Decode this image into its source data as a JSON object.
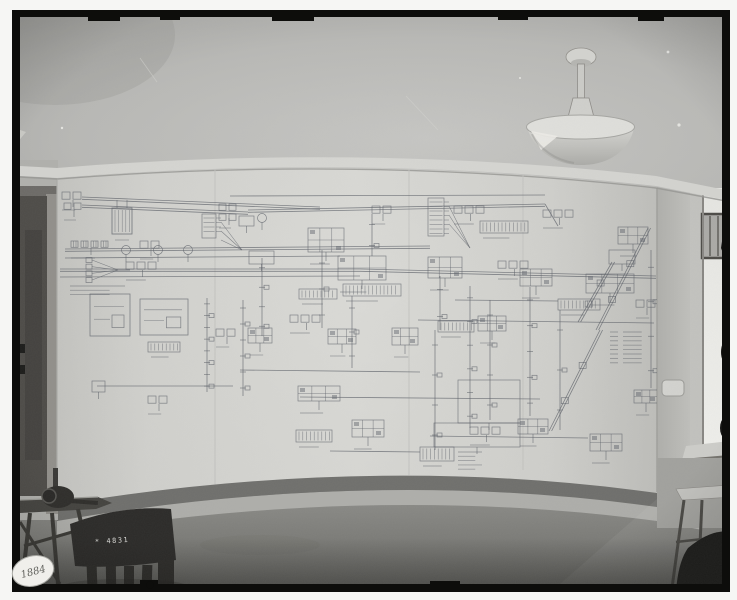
{
  "photo": {
    "kind": "black-and-white room photograph",
    "labels": {
      "chair_number": "* 4831",
      "sticker_number": "1884"
    }
  },
  "palette": {
    "plate_black": "#0d0d0b",
    "ceiling": "#c2c2bf",
    "molding": "#d8d8d4",
    "sheet": "#d8d8d4",
    "ink": "#5c6068",
    "door": "#4f4d49",
    "floor": "#8d8d89",
    "baseboard": "#71716e",
    "window_glass": "#f0f0ec",
    "chair": "#2c2b29",
    "sticker": "#f0efeb",
    "lamp": "#d7d7d3"
  },
  "schematic": {
    "ink": "#5c6068",
    "seams": [
      {
        "x": 215,
        "y1": 168,
        "y2": 498
      },
      {
        "x": 409,
        "y1": 160,
        "y2": 476
      },
      {
        "x": 523,
        "y1": 164,
        "y2": 470
      }
    ],
    "buses": [
      {
        "p": [
          82,
          197,
          320,
          207
        ],
        "d": true
      },
      {
        "p": [
          82,
          205,
          248,
          212
        ],
        "d": true
      },
      {
        "p": [
          248,
          210,
          545,
          204
        ],
        "d": true
      },
      {
        "p": [
          545,
          204,
          558,
          226
        ],
        "d": false
      },
      {
        "p": [
          230,
          196,
          545,
          195
        ],
        "d": false
      },
      {
        "p": [
          65,
          249,
          430,
          246
        ],
        "d": true
      },
      {
        "p": [
          65,
          258,
          340,
          256
        ],
        "d": false
      },
      {
        "p": [
          60,
          269,
          360,
          269
        ],
        "d": true
      },
      {
        "p": [
          360,
          269,
          656,
          276
        ],
        "d": true
      },
      {
        "p": [
          60,
          277,
          360,
          276
        ],
        "d": false
      },
      {
        "p": [
          418,
          320,
          654,
          323
        ],
        "d": false
      },
      {
        "p": [
          455,
          300,
          558,
          301
        ],
        "d": false
      },
      {
        "p": [
          97,
          386,
          233,
          386
        ],
        "d": false
      },
      {
        "p": [
          240,
          370,
          420,
          372
        ],
        "d": false
      },
      {
        "p": [
          300,
          397,
          540,
          399
        ],
        "d": false
      },
      {
        "p": [
          430,
          436,
          588,
          438
        ],
        "d": false
      },
      {
        "p": [
          330,
          451,
          420,
          452
        ],
        "d": false
      }
    ],
    "verticals": [
      {
        "x": 207,
        "y1": 298,
        "y2": 392,
        "t": 8
      },
      {
        "x": 243,
        "y1": 300,
        "y2": 396,
        "t": 6
      },
      {
        "x": 262,
        "y1": 258,
        "y2": 336,
        "t": 4
      },
      {
        "x": 352,
        "y1": 296,
        "y2": 368,
        "t": 3
      },
      {
        "x": 435,
        "y1": 330,
        "y2": 450,
        "t": 4
      },
      {
        "x": 440,
        "y1": 276,
        "y2": 330,
        "t": 2
      },
      {
        "x": 470,
        "y1": 286,
        "y2": 428,
        "t": 6
      },
      {
        "x": 490,
        "y1": 300,
        "y2": 420,
        "t": 4
      },
      {
        "x": 530,
        "y1": 287,
        "y2": 416,
        "t": 5
      },
      {
        "x": 560,
        "y1": 310,
        "y2": 430,
        "t": 3
      },
      {
        "x": 651,
        "y1": 250,
        "y2": 388,
        "t": 4
      },
      {
        "x": 322,
        "y1": 250,
        "y2": 328,
        "t": 3
      },
      {
        "x": 372,
        "y1": 214,
        "y2": 256,
        "t": 2
      }
    ],
    "diagonals": [
      {
        "p": [
          648,
          228,
          596,
          330
        ]
      },
      {
        "p": [
          600,
          330,
          549,
          431
        ]
      },
      {
        "p": [
          612,
          262,
          578,
          322
        ]
      }
    ],
    "clusters": [
      {
        "t": "row",
        "x": 62,
        "y": 192,
        "n": 2,
        "s": 8
      },
      {
        "t": "row",
        "x": 64,
        "y": 203,
        "n": 2,
        "s": 7
      },
      {
        "t": "hatchbox",
        "x": 112,
        "y": 208,
        "w": 20,
        "h": 26
      },
      {
        "t": "vcomb",
        "x": 202,
        "y": 214,
        "w": 14,
        "h": 24
      },
      {
        "t": "grid",
        "x": 219,
        "y": 204,
        "n": 2,
        "s": 7
      },
      {
        "t": "block",
        "x": 239,
        "y": 216,
        "w": 15,
        "h": 10
      },
      {
        "t": "dense",
        "x": 308,
        "y": 228,
        "w": 36,
        "h": 24
      },
      {
        "t": "vcomb",
        "x": 428,
        "y": 198,
        "w": 16,
        "h": 38
      },
      {
        "t": "row",
        "x": 454,
        "y": 206,
        "n": 3,
        "s": 8
      },
      {
        "t": "comb",
        "x": 480,
        "y": 221,
        "w": 48,
        "h": 12
      },
      {
        "t": "row",
        "x": 543,
        "y": 210,
        "n": 3,
        "s": 8
      },
      {
        "t": "dense",
        "x": 618,
        "y": 227,
        "w": 30,
        "h": 17
      },
      {
        "t": "block",
        "x": 609,
        "y": 250,
        "w": 26,
        "h": 14
      },
      {
        "t": "coils",
        "x": 71,
        "y": 241,
        "n": 4,
        "s": 7
      },
      {
        "t": "fan",
        "x": 92,
        "y": 260,
        "w": 26,
        "h": 20
      },
      {
        "t": "row",
        "x": 126,
        "y": 262,
        "n": 3,
        "s": 8
      },
      {
        "t": "circ",
        "x": 126,
        "y": 250
      },
      {
        "t": "circ",
        "x": 158,
        "y": 250
      },
      {
        "t": "circ",
        "x": 188,
        "y": 250
      },
      {
        "t": "row",
        "x": 140,
        "y": 241,
        "n": 2,
        "s": 8
      },
      {
        "t": "block",
        "x": 249,
        "y": 251,
        "w": 25,
        "h": 13
      },
      {
        "t": "dense",
        "x": 338,
        "y": 256,
        "w": 48,
        "h": 24
      },
      {
        "t": "comb",
        "x": 343,
        "y": 284,
        "w": 58,
        "h": 12
      },
      {
        "t": "comb",
        "x": 299,
        "y": 289,
        "w": 38,
        "h": 10
      },
      {
        "t": "dense",
        "x": 428,
        "y": 257,
        "w": 34,
        "h": 21
      },
      {
        "t": "row",
        "x": 498,
        "y": 261,
        "n": 3,
        "s": 8
      },
      {
        "t": "dense",
        "x": 520,
        "y": 269,
        "w": 32,
        "h": 17
      },
      {
        "t": "dense",
        "x": 586,
        "y": 274,
        "w": 48,
        "h": 19
      },
      {
        "t": "comb",
        "x": 558,
        "y": 299,
        "w": 42,
        "h": 11
      },
      {
        "t": "textrows",
        "x": 70,
        "y": 286,
        "n": 3,
        "w": 55
      },
      {
        "t": "blockin",
        "x": 90,
        "y": 294,
        "w": 40,
        "h": 42
      },
      {
        "t": "blockin",
        "x": 140,
        "y": 299,
        "w": 48,
        "h": 36
      },
      {
        "t": "comb",
        "x": 148,
        "y": 342,
        "w": 32,
        "h": 10
      },
      {
        "t": "row",
        "x": 216,
        "y": 329,
        "n": 2,
        "s": 8
      },
      {
        "t": "dense",
        "x": 248,
        "y": 328,
        "w": 24,
        "h": 15
      },
      {
        "t": "row",
        "x": 290,
        "y": 315,
        "n": 3,
        "s": 8
      },
      {
        "t": "dense",
        "x": 328,
        "y": 329,
        "w": 28,
        "h": 15
      },
      {
        "t": "dense",
        "x": 392,
        "y": 328,
        "w": 26,
        "h": 17
      },
      {
        "t": "comb",
        "x": 438,
        "y": 321,
        "w": 36,
        "h": 11
      },
      {
        "t": "dense",
        "x": 478,
        "y": 316,
        "w": 28,
        "h": 15
      },
      {
        "t": "legend",
        "x": 610,
        "y": 332,
        "n": 8,
        "w": 34
      },
      {
        "t": "block",
        "x": 92,
        "y": 381,
        "w": 13,
        "h": 11
      },
      {
        "t": "row",
        "x": 148,
        "y": 396,
        "n": 2,
        "s": 8
      },
      {
        "t": "dense",
        "x": 298,
        "y": 386,
        "w": 42,
        "h": 15
      },
      {
        "t": "comb",
        "x": 296,
        "y": 430,
        "w": 36,
        "h": 12
      },
      {
        "t": "dense",
        "x": 352,
        "y": 420,
        "w": 32,
        "h": 17
      },
      {
        "t": "block",
        "x": 434,
        "y": 423,
        "w": 86,
        "h": 24
      },
      {
        "t": "block",
        "x": 458,
        "y": 380,
        "w": 62,
        "h": 43
      },
      {
        "t": "comb",
        "x": 420,
        "y": 447,
        "w": 34,
        "h": 14
      },
      {
        "t": "textrows",
        "x": 458,
        "y": 452,
        "n": 5,
        "w": 24
      },
      {
        "t": "row",
        "x": 470,
        "y": 427,
        "n": 3,
        "s": 8
      },
      {
        "t": "dense",
        "x": 518,
        "y": 419,
        "w": 30,
        "h": 15
      },
      {
        "t": "dense",
        "x": 590,
        "y": 434,
        "w": 32,
        "h": 17
      },
      {
        "t": "row",
        "x": 636,
        "y": 300,
        "n": 2,
        "s": 8
      },
      {
        "t": "dense",
        "x": 634,
        "y": 390,
        "w": 24,
        "h": 13
      },
      {
        "t": "circ",
        "x": 262,
        "y": 218
      },
      {
        "t": "row",
        "x": 372,
        "y": 206,
        "n": 2,
        "s": 8
      }
    ]
  }
}
